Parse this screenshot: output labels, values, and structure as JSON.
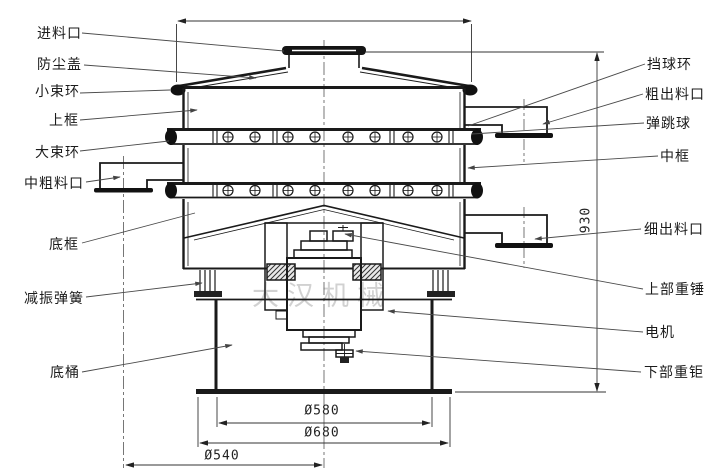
{
  "watermark": "大汉机械",
  "labels": {
    "left": [
      {
        "text": "进料口"
      },
      {
        "text": "防尘盖"
      },
      {
        "text": "小束环"
      },
      {
        "text": "上框"
      },
      {
        "text": "大束环"
      },
      {
        "text": "中粗料口"
      },
      {
        "text": "底框"
      },
      {
        "text": "减振弹簧"
      },
      {
        "text": "底桶"
      }
    ],
    "right": [
      {
        "text": "挡球环"
      },
      {
        "text": "粗出料口"
      },
      {
        "text": "弹跳球"
      },
      {
        "text": "中框"
      },
      {
        "text": "细出料口"
      },
      {
        "text": "上部重锤"
      },
      {
        "text": "电机"
      },
      {
        "text": "下部重钜"
      }
    ]
  },
  "dimensions": {
    "height": "930",
    "inner_diameter": "Ø580",
    "outer_diameter": "Ø680",
    "base_diameter": "Ø540"
  }
}
